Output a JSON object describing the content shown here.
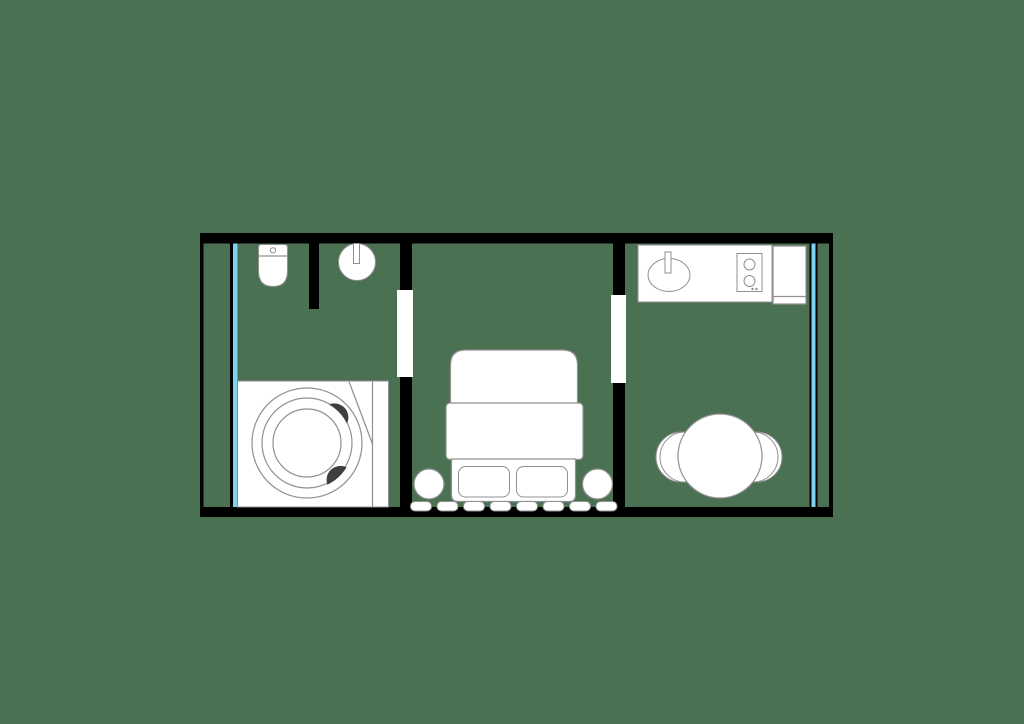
{
  "diagram": {
    "type": "floor-plan",
    "title": "three-room apartment floor plan",
    "background_color": "#4a7152",
    "colors": {
      "wall_color": "#000000",
      "fixture_fill": "#ffffff",
      "outline_color": "#909090",
      "glass_color": "#7cd4f1",
      "accent_dark": "#3f3f3f"
    },
    "rooms": [
      {
        "name": "bathroom",
        "position": "left",
        "fixtures": [
          "toilet",
          "privacy-partition",
          "round-washbasin",
          "round-bathtub-on-deck"
        ]
      },
      {
        "name": "bedroom",
        "position": "center",
        "fixtures": [
          "double-bed",
          "pillow-left",
          "pillow-right",
          "nightstand-left",
          "nightstand-right",
          "radiator-8-fins"
        ]
      },
      {
        "name": "kitchen-dining",
        "position": "right",
        "fixtures": [
          "kitchen-counter",
          "kitchen-sink",
          "cooktop-2-burners",
          "refrigerator",
          "round-dining-table",
          "chair-left",
          "chair-right"
        ]
      }
    ],
    "openings": [
      {
        "name": "door-opening-bathroom-bedroom",
        "between": "bathroom and bedroom"
      },
      {
        "name": "door-opening-bedroom-kitchen",
        "between": "bedroom and kitchen-dining"
      },
      {
        "name": "window-left",
        "wall": "left exterior, full height"
      },
      {
        "name": "window-right",
        "wall": "right exterior, full height"
      }
    ]
  }
}
